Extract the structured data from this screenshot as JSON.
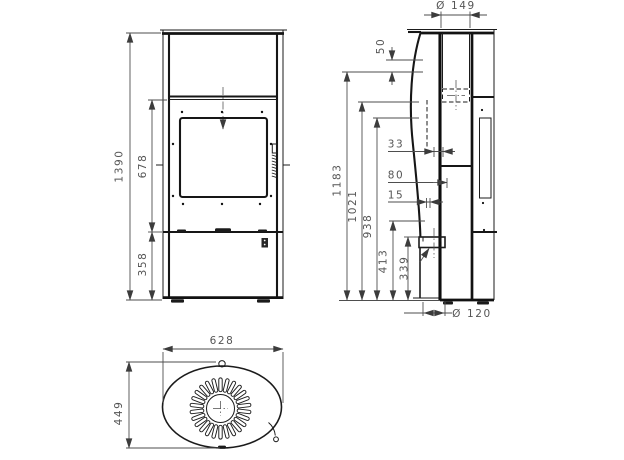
{
  "dimensions": {
    "front_view": {
      "overall_height": "1390",
      "middle_section_height": "678",
      "base_section_height": "358"
    },
    "side_view": {
      "flue_collar_diameter": "Ø 149",
      "flue_top_offset": "50",
      "offset_33": "33",
      "offset_80": "80",
      "offset_15": "15",
      "height_1183": "1183",
      "height_1021": "1021",
      "height_938": "938",
      "height_413": "413",
      "height_339": "339",
      "air_inlet_diameter": "Ø 120"
    },
    "top_view": {
      "overall_width": "628",
      "overall_depth": "449"
    }
  }
}
